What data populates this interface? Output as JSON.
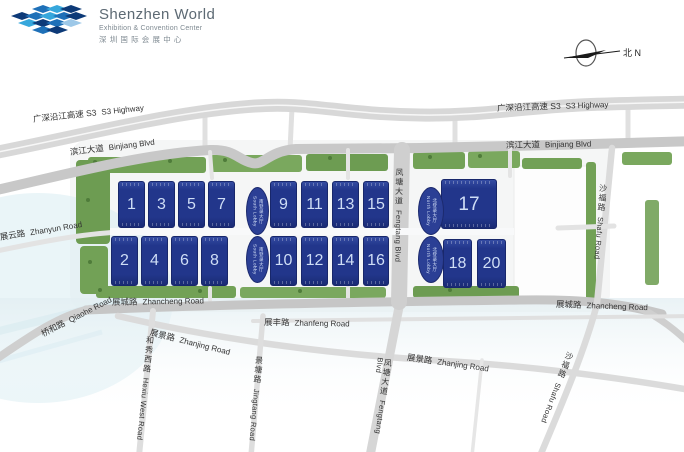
{
  "logo": {
    "title": "Shenzhen World",
    "subtitle": "Exhibition & Convention Center",
    "subtitle_zh": "深圳国际会展中心"
  },
  "compass": {
    "label": "北 N"
  },
  "roads": {
    "s3": {
      "zh": "广深沿江高速 S3",
      "en": "S3 Highway"
    },
    "binjiang": {
      "zh": "滨江大道",
      "en": "Binjiang Blvd"
    },
    "zhanyun": {
      "zh": "展云路",
      "en": "Zhanyun Road"
    },
    "qiaohe": {
      "zh": "桥和路",
      "en": "Qiaohe Road"
    },
    "zhancheng": {
      "zh": "展城路",
      "en": "Zhancheng Road"
    },
    "zhanfeng": {
      "zh": "展丰路",
      "en": "Zhanfeng Road"
    },
    "zhanjing": {
      "zh": "展景路",
      "en": "Zhanjing Road"
    },
    "hexiu": {
      "zh": "和秀西路",
      "en": "Hexiu West Road"
    },
    "jingtang": {
      "zh": "景塘路",
      "en": "Jingtang Road"
    },
    "fengtang": {
      "zh": "凤塘大道",
      "en": "Fengtang Blvd"
    },
    "shafu": {
      "zh": "沙福路",
      "en": "Shafu Road"
    }
  },
  "halls": {
    "numbers": [
      "1",
      "3",
      "5",
      "7",
      "9",
      "11",
      "13",
      "15",
      "2",
      "4",
      "6",
      "8",
      "10",
      "12",
      "14",
      "16",
      "17",
      "18",
      "20"
    ]
  },
  "lobbies": {
    "south": {
      "zh": "南登录大厅",
      "en": "South Lobby"
    },
    "north": {
      "zh": "北登录大厅",
      "en": "North Lobby"
    }
  },
  "colors": {
    "hall_blue": "#22368b",
    "lobby_blue": "#2b3f95",
    "green": "#72a156",
    "road_gray": "#c8c8c8",
    "logo_light_blue": "#36a7dc",
    "logo_mid_blue": "#1e70b8",
    "logo_navy": "#0d3a78",
    "label_text": "#333333"
  }
}
